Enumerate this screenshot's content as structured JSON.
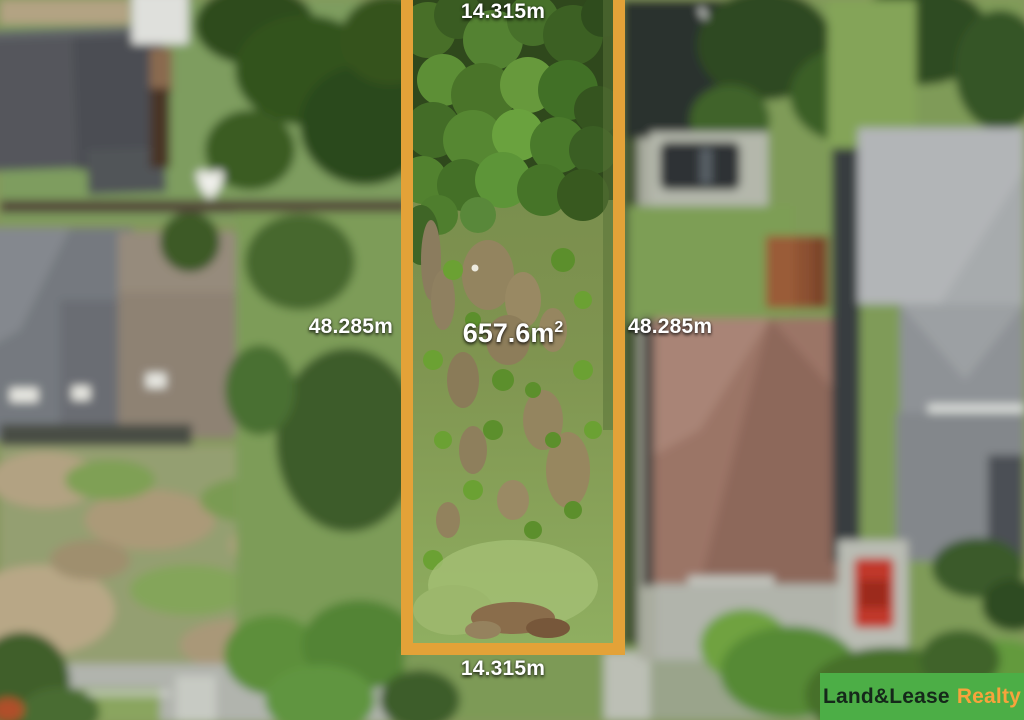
{
  "measurements": {
    "top_width": "14.315m",
    "bottom_width": "14.315m",
    "left_depth": "48.285m",
    "right_depth": "48.285m",
    "area_value": "657.6m",
    "area_superscript": "2"
  },
  "branding": {
    "name_primary": "Land&Lease",
    "name_secondary": "Realty"
  },
  "colors": {
    "boundary_outline": "#E3A238",
    "logo_background": "#4CAE46",
    "logo_primary_text": "#15281A",
    "logo_secondary_text": "#F8A33C",
    "dimension_text": "#FFFFFF"
  }
}
